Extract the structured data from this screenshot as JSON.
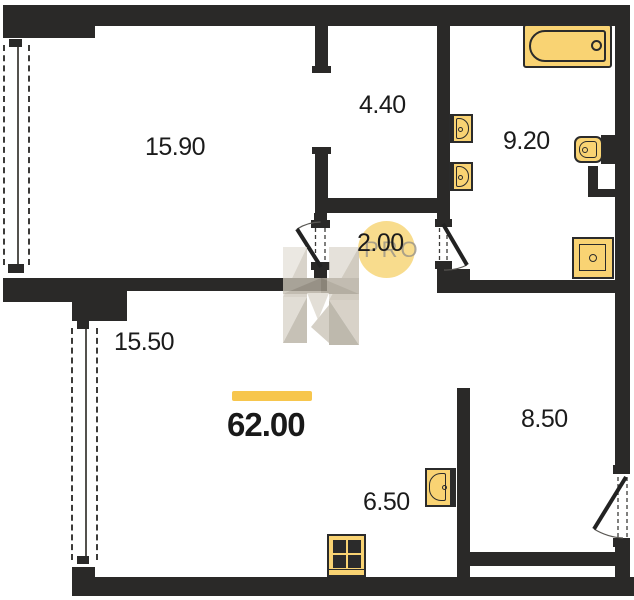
{
  "rooms": {
    "living": "15.90",
    "wardrobe": "4.40",
    "bathroom": "9.20",
    "hall": "2.00",
    "bedroom": "15.50",
    "entry": "8.50",
    "kitchen": "6.50"
  },
  "total_area": "62.00",
  "watermark": {
    "brand": "PRO"
  },
  "colors": {
    "wall": "#2a2928",
    "fixture_fill": "#f9d373",
    "fixture_outline": "#2b2b2b",
    "accent_bar": "#f7c64d",
    "watermark_circle": "#f8da87",
    "label_text": "#1b1b1b"
  }
}
